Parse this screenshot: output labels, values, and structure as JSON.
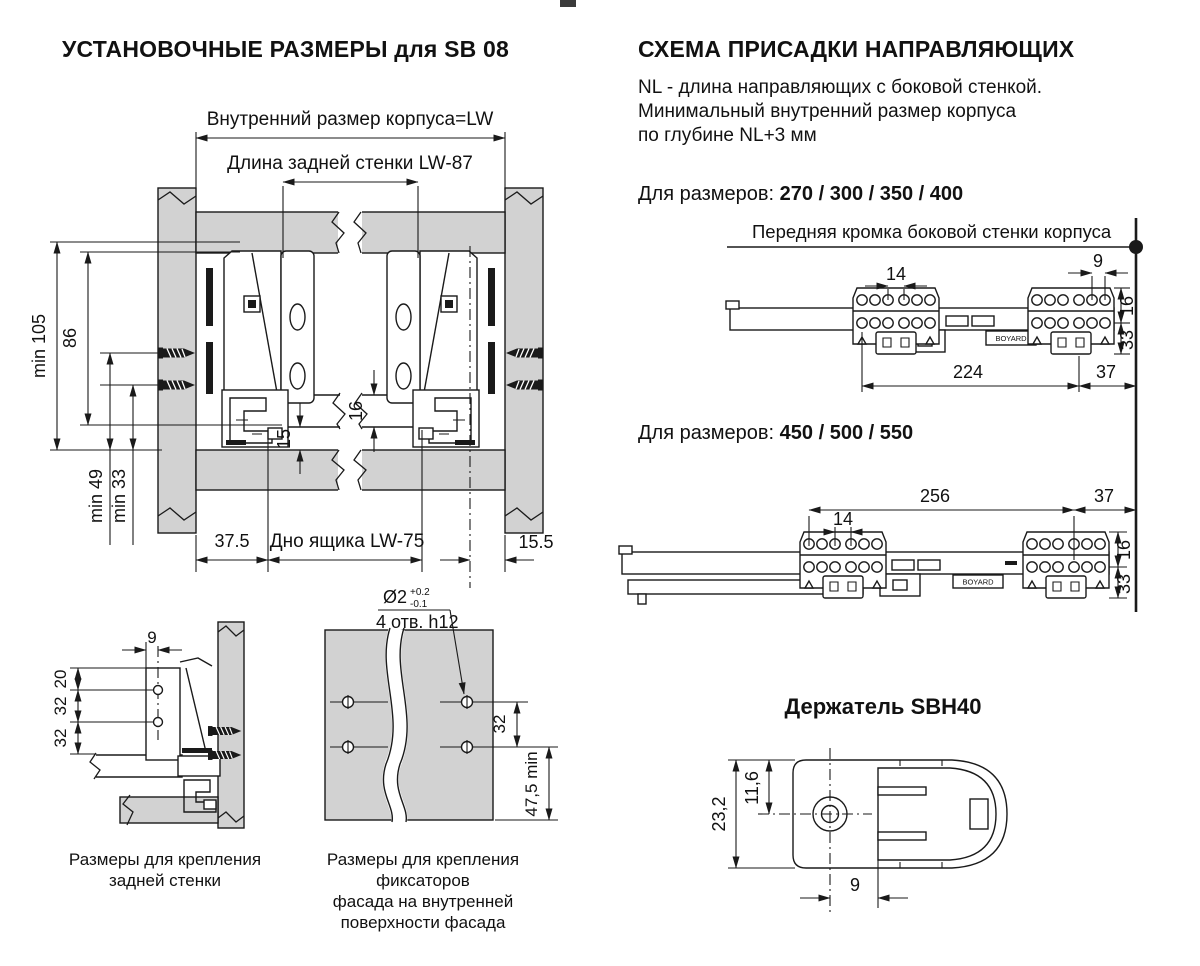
{
  "left_section": {
    "title": "УСТАНОВОЧНЫЕ РАЗМЕРЫ для SB 08",
    "main_diagram": {
      "dim_inner_width": "Внутренний размер корпуса=LW",
      "dim_back_wall": "Длина задней стенки  LW-87",
      "dim_min_105": "min 105",
      "dim_86": "86",
      "dim_min_49": "min 49",
      "dim_min_33": "min 33",
      "dim_16": "16",
      "dim_15": "15",
      "dim_37_5": "37.5",
      "dim_bottom": "Дно ящика  LW-75",
      "dim_15_5": "15.5"
    },
    "rear_diagram": {
      "dim_9": "9",
      "dim_20": "20",
      "dim_32_a": "32",
      "dim_32_b": "32",
      "caption": [
        "Размеры  для крепления",
        "задней стенки"
      ]
    },
    "facade_diagram": {
      "callout_diameter": "Ø2",
      "tolerance_plus": "+0.2",
      "tolerance_minus": "-0.1",
      "callout_holes": "4 отв. h12",
      "dim_32": "32",
      "dim_47_5": "47,5 min",
      "caption": [
        "Размеры для крепления фиксаторов",
        "фасада на внутренней",
        "поверхности фасада"
      ]
    }
  },
  "right_section": {
    "title": "СХЕМА ПРИСАДКИ НАПРАВЛЯЮЩИХ",
    "description": [
      "NL - длина направляющих с боковой стенкой.",
      "Минимальный внутренний размер корпуса",
      "по глубине NL+3 мм"
    ],
    "sizes_small": {
      "label": "Для размеров:",
      "values": "270 / 300 / 350 / 400"
    },
    "front_edge_label": "Передняя кромка боковой стенки корпуса",
    "diagram_small": {
      "dim_14": "14",
      "dim_9": "9",
      "dim_16": "16",
      "dim_33": "33",
      "dim_224": "224",
      "dim_37": "37"
    },
    "sizes_large": {
      "label": "Для размеров:",
      "values": "450 / 500 / 550"
    },
    "diagram_large": {
      "dim_256": "256",
      "dim_37": "37",
      "dim_14": "14",
      "dim_16": "16",
      "dim_33": "33"
    },
    "brand": "BOYARD",
    "holder": {
      "title": "Держатель SBH40",
      "dim_23_2": "23,2",
      "dim_11_6": "11,6",
      "dim_9": "9"
    }
  },
  "colors": {
    "panel_gray": "#d2d2d2",
    "line": "#1a1a1a"
  }
}
